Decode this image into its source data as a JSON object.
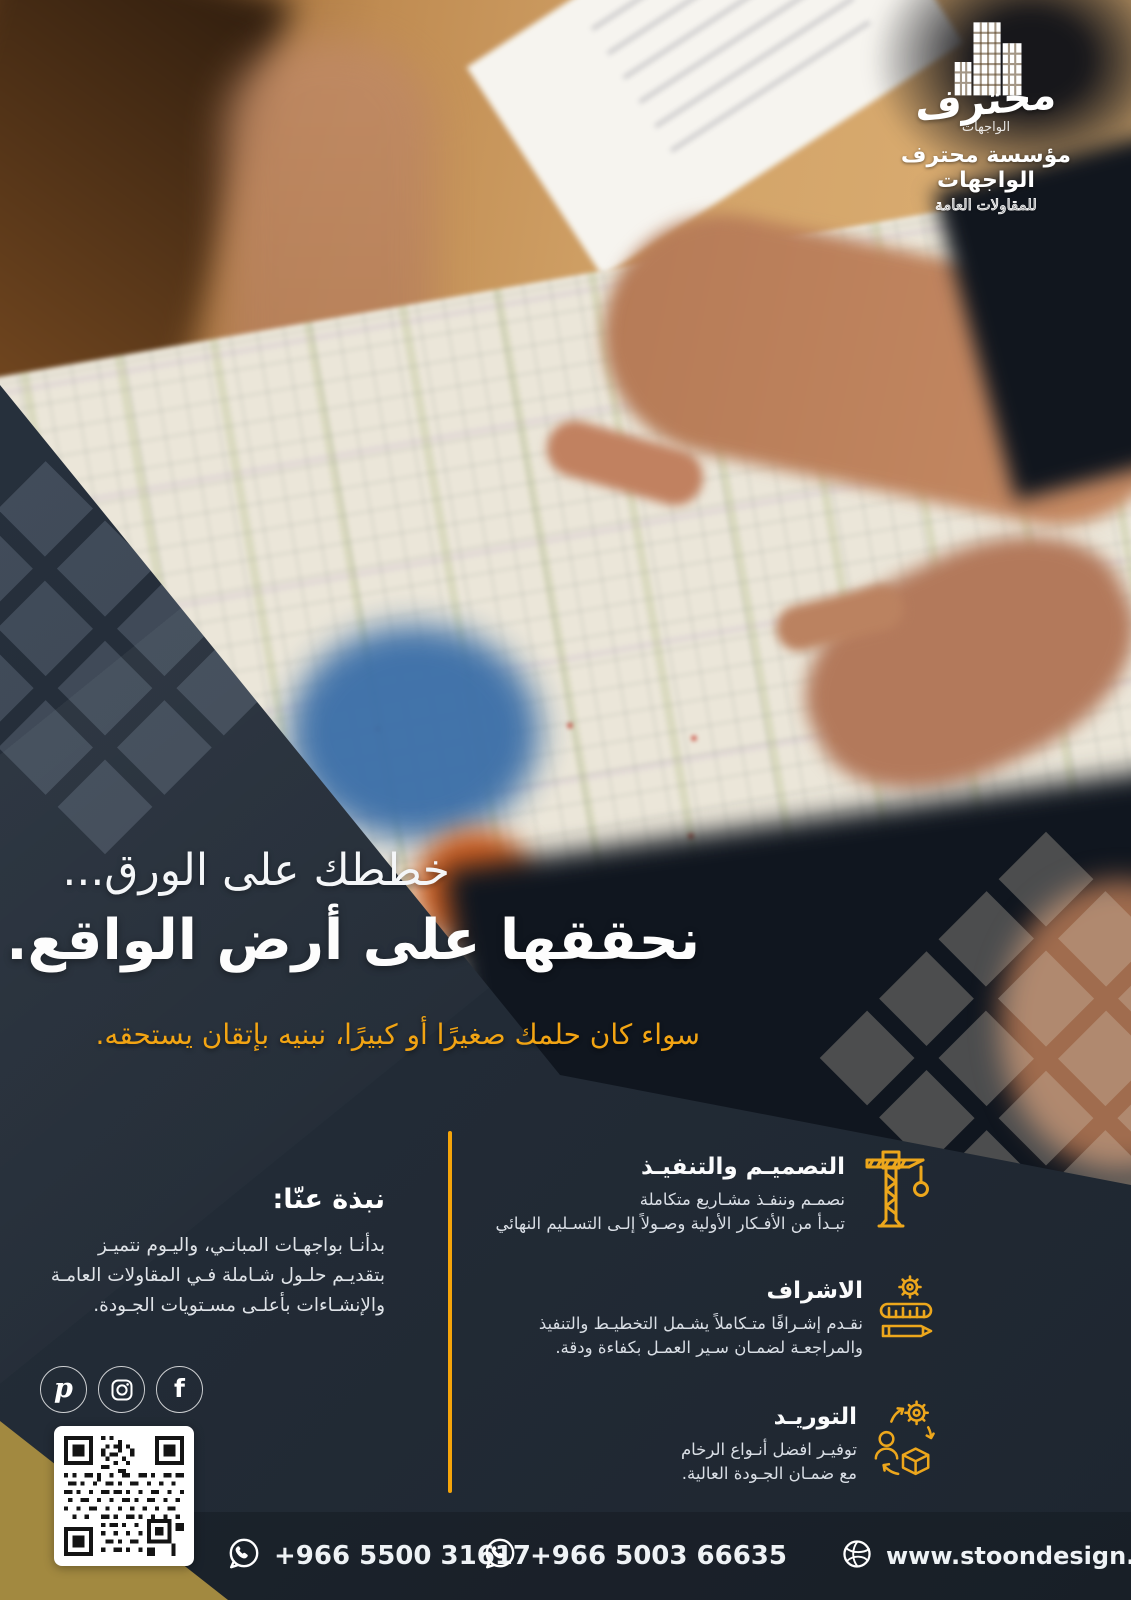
{
  "brand": {
    "logo_calligraphy": "محترف",
    "logo_sub": "الواجهات",
    "name": "مؤسسة محترف الواجهات",
    "tagline": "للمقاولات العامة"
  },
  "hero": {
    "headline_line1": "خططك على الورق...",
    "headline_line2": "نحققها على أرض الواقع.",
    "subtitle": "سواء كان حلمك صغيرًا أو كبيرًا، نبنيه بإتقان يستحقه."
  },
  "services": [
    {
      "icon": "crane-icon",
      "title": "التصميـم والتنفيـذ",
      "description": "نصمـم وننفـذ مشـاريع متكاملة\nتبـدأ من الأفـكار الأولية وصـولاً إلـى التسـليم النهائي"
    },
    {
      "icon": "supervision-icon",
      "title": "الاشراف",
      "description": "نقـدم إشـرافًا متـكاملاً يشـمل التخطيـط والتنفيذ\nوالمراجعـة لضمـان سـير العمـل بكفاءة ودقة."
    },
    {
      "icon": "supply-icon",
      "title": "التوريـد",
      "description": "توفيـر افضل أنـواع الرخام\nمع ضمـان الجـودة العالية."
    }
  ],
  "about": {
    "heading": "نبذة عنّا:",
    "body": "بدأنـا بواجهـات المبانـي، واليـوم نتميـز\nبتقديـم حلـول شـاملة فـي المقاولات العامـة\nوالإنشـاءات بأعلـى مسـتويات الجـودة."
  },
  "social": [
    {
      "name": "pinterest"
    },
    {
      "name": "instagram"
    },
    {
      "name": "facebook"
    }
  ],
  "footer": {
    "phone1": "+966 5500 31617",
    "phone2": "+966 5003 66635",
    "website": "www.stoondesign.com"
  },
  "colors": {
    "navy": "#232C37",
    "accent_yellow": "#F2A413",
    "icon_gold": "#EDA71C",
    "corner_gold": "#A28940"
  }
}
